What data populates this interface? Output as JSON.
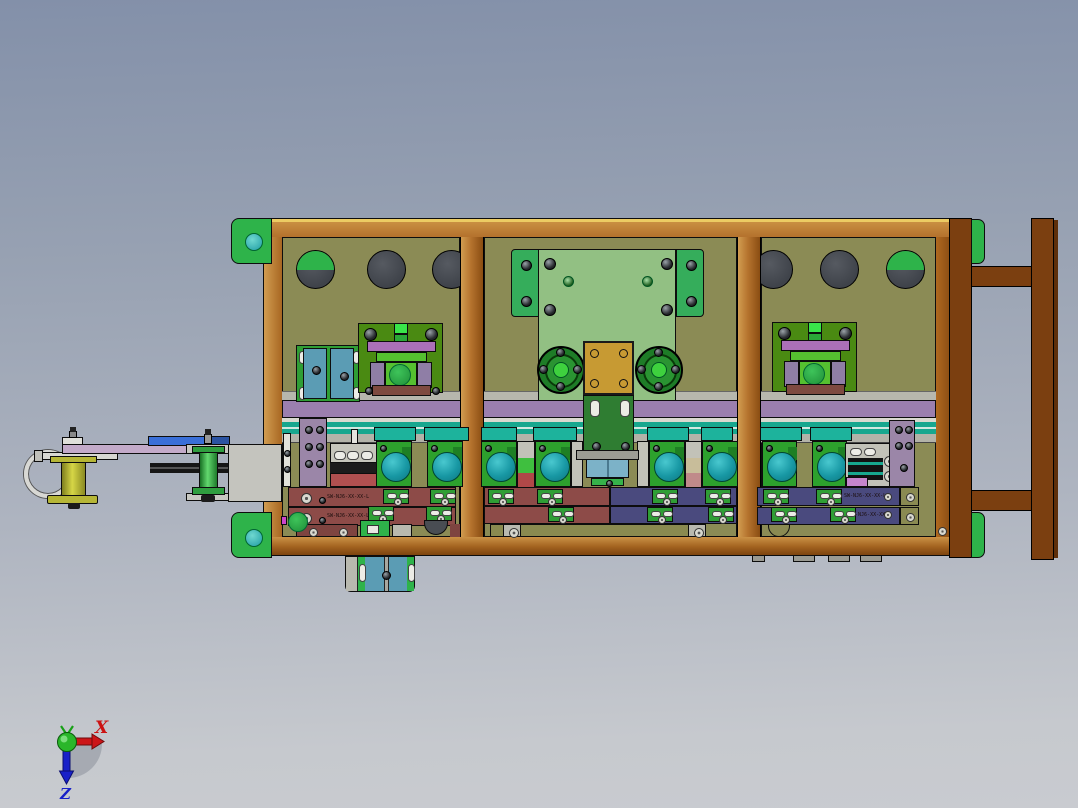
{
  "scene": {
    "type": "3d-cad-assembly-view",
    "background": {
      "top": "#8390a9",
      "bottom": "#c9cbd0"
    }
  },
  "orientation_triad": {
    "x_axis": {
      "label": "X",
      "color": "#cc1212"
    },
    "z_axis": {
      "label": "Z",
      "color": "#1820c8"
    },
    "y_axis": {
      "label": "",
      "color": "#17a017"
    },
    "origin_color": "#2ab62a"
  },
  "assembly": {
    "frame_color": "#b5732e",
    "stand_color": "#7b3f10",
    "corner_bracket_color": "#2eb34a",
    "back_panel_color": "#8b8b55",
    "guide_rail_purple": "#9b7fae",
    "guide_rail_teal": "#17a78e",
    "roller_block_green": "#2da12d",
    "roller_eye_teal": "#1898a4",
    "clamp_bar_maroon": "#8d4b48",
    "clamp_bar_navy": "#4a4a7e",
    "gold_plate": "#c79a33",
    "engraved_labels": [
      "SW-NJ6-XX-XX-L",
      "SW-NJ6-XX-XX-L",
      "SW-NJ6-XX-XX-L",
      "SW-NJ6-XX-XX-L"
    ]
  }
}
